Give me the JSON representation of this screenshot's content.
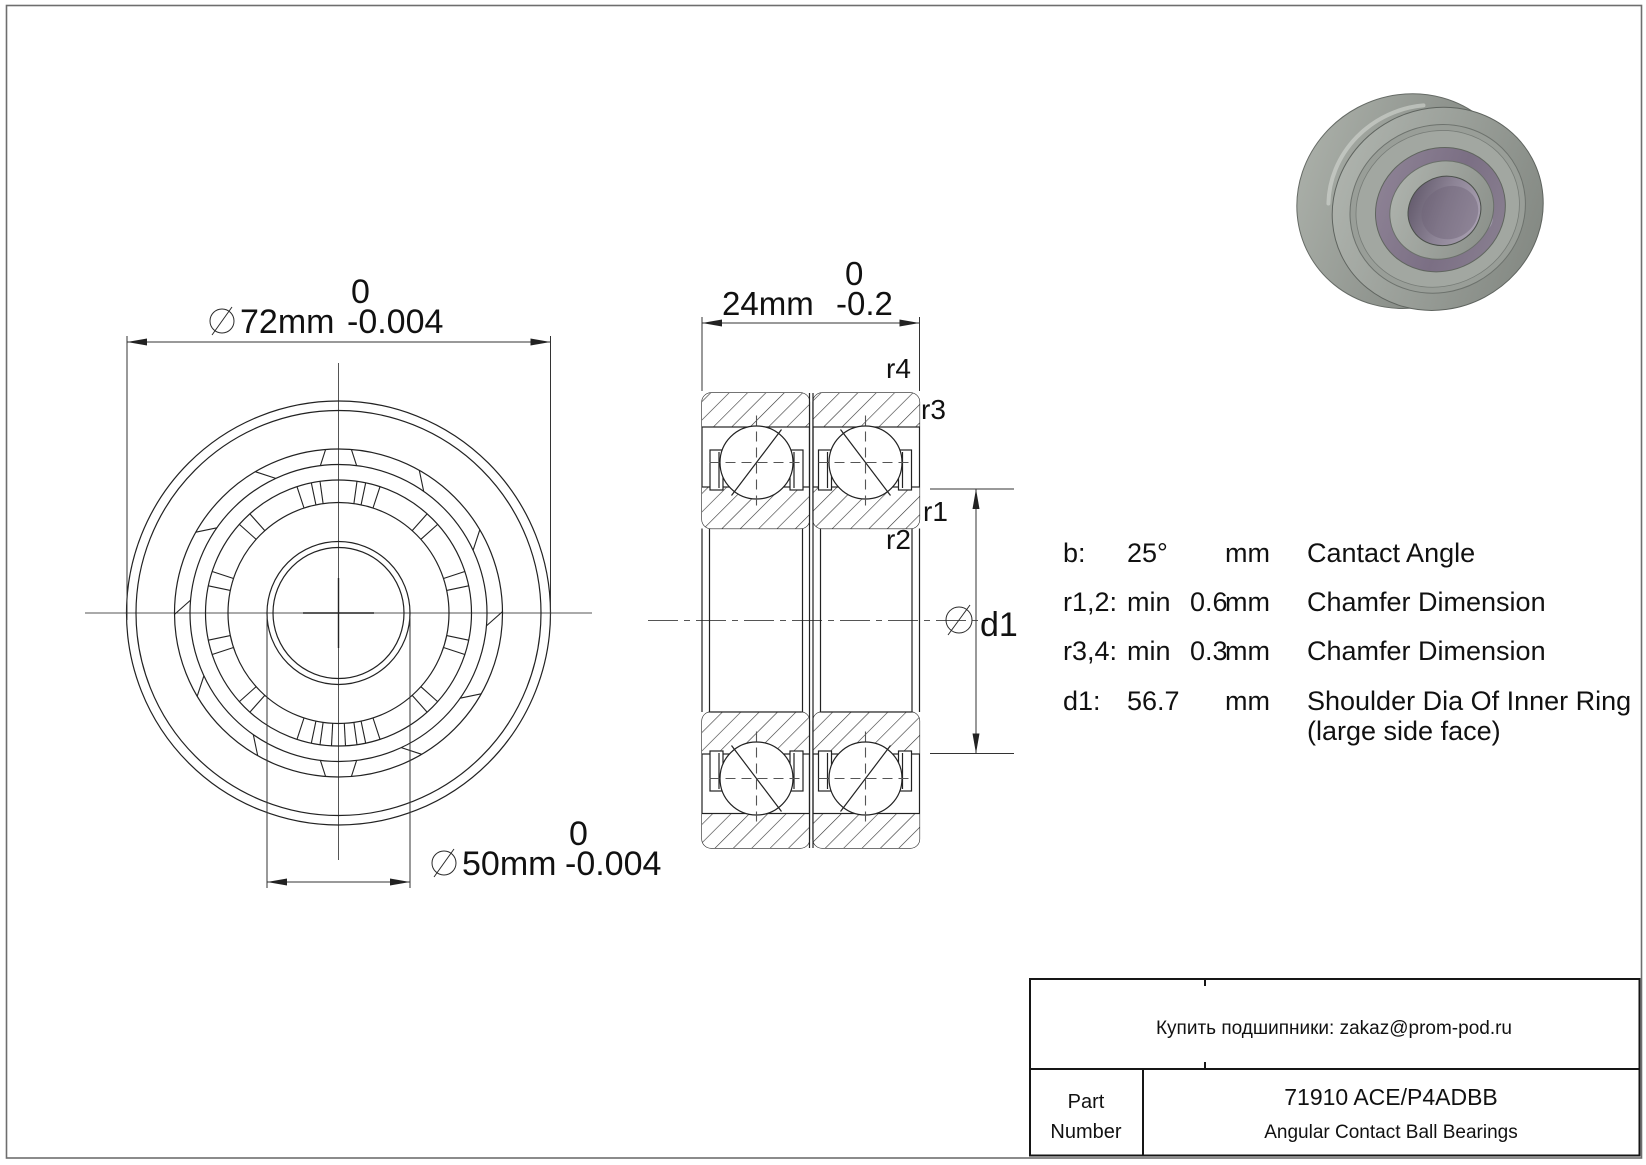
{
  "front_view": {
    "outer_dim": {
      "value": "72mm",
      "tolerance_upper": "0",
      "tolerance_lower": "-0.004"
    },
    "bore_dim": {
      "value": "50mm",
      "tolerance_upper": "0",
      "tolerance_lower": "-0.004"
    }
  },
  "section_view": {
    "width_dim": {
      "value": "24mm",
      "tolerance_upper": "0",
      "tolerance_lower": "-0.2"
    },
    "chamfer_labels": {
      "r1": "r1",
      "r2": "r2",
      "r3": "r3",
      "r4": "r4"
    },
    "shoulder_dim_label": "d1"
  },
  "spec_table": {
    "rows": [
      {
        "label": "b:",
        "qualifier": "",
        "value": "25°",
        "unit": "mm",
        "description": "Cantact Angle",
        "description_line2": ""
      },
      {
        "label": "r1,2:",
        "qualifier": "min",
        "value": "0.6",
        "unit": "mm",
        "description": "Chamfer Dimension",
        "description_line2": ""
      },
      {
        "label": "r3,4:",
        "qualifier": "min",
        "value": "0.3",
        "unit": "mm",
        "description": "Chamfer Dimension",
        "description_line2": ""
      },
      {
        "label": "d1:",
        "qualifier": "",
        "value": "56.7",
        "unit": "mm",
        "description": "Shoulder Dia Of Inner Ring",
        "description_line2": "(large side face)"
      }
    ]
  },
  "title_block": {
    "contact_line": "Купить подшипники: zakaz@prom-pod.ru",
    "part_label_line1": "Part",
    "part_label_line2": "Number",
    "part_number": "71910 ACE/P4ADBB",
    "part_type": "Angular Contact Ball Bearings"
  },
  "product_image": {
    "name": "angular-contact-ball-bearing-3d-render"
  }
}
